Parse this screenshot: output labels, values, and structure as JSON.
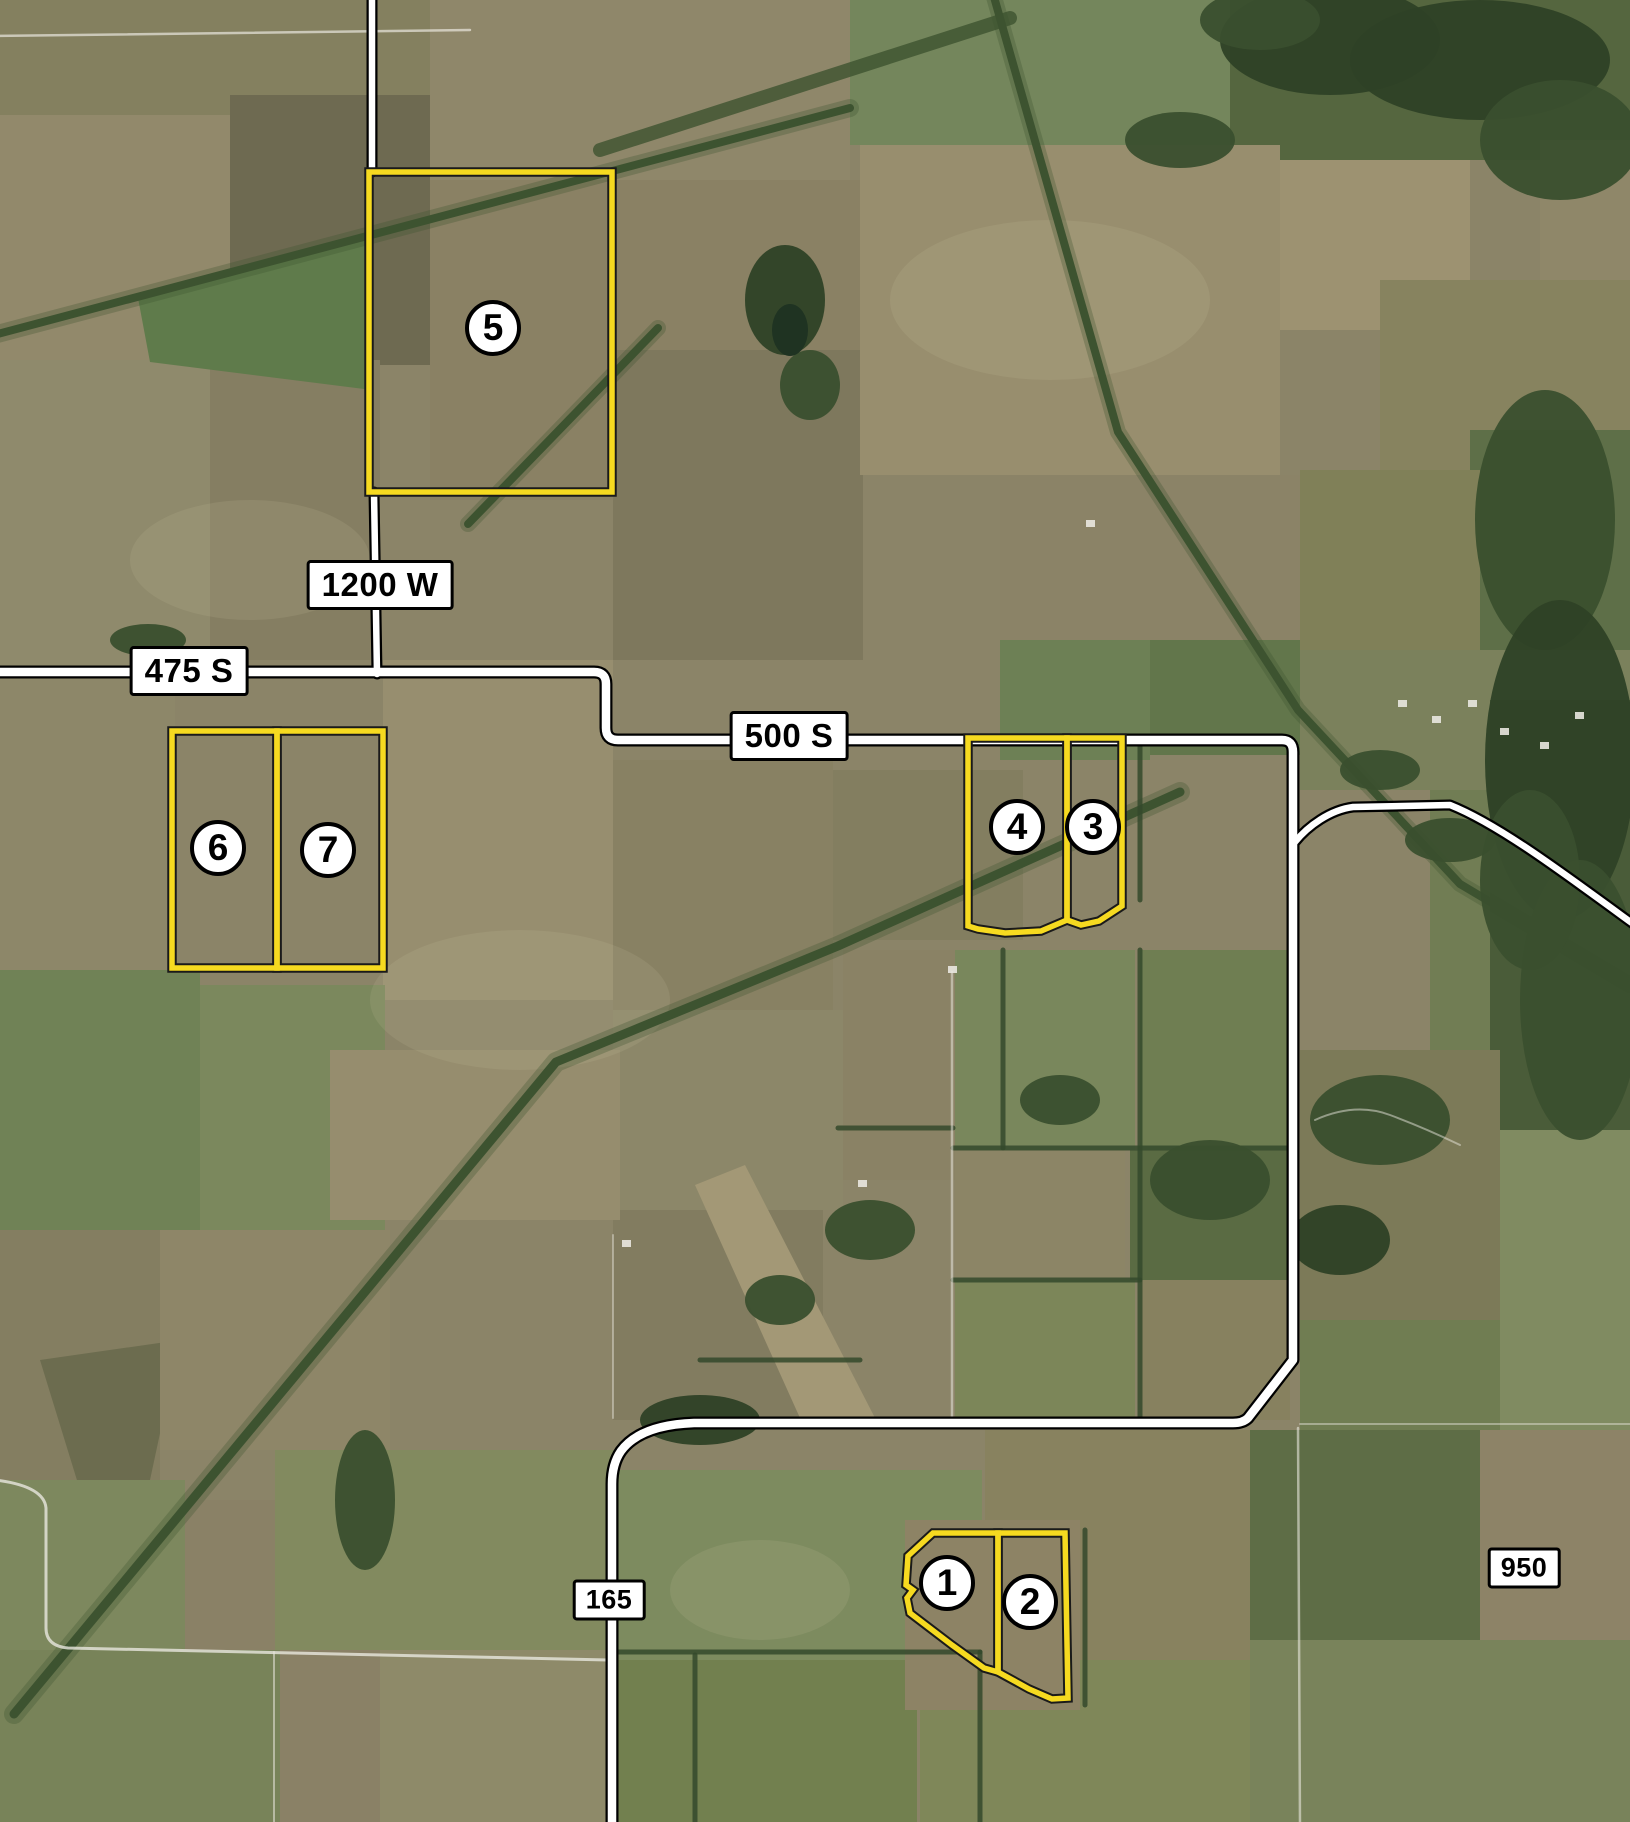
{
  "map": {
    "road_labels": [
      {
        "text": "1200 W"
      },
      {
        "text": "475 S"
      },
      {
        "text": "500 S"
      },
      {
        "text": "165"
      },
      {
        "text": "950"
      }
    ],
    "tracts": [
      {
        "number": "1"
      },
      {
        "number": "2"
      },
      {
        "number": "3"
      },
      {
        "number": "4"
      },
      {
        "number": "5"
      },
      {
        "number": "6"
      },
      {
        "number": "7"
      }
    ],
    "colors": {
      "parcel_outline": "#F6DA20",
      "outline_casing": "#1A1A1A",
      "road_highlight": "#FFFFFF",
      "road_casing": "#000000",
      "label_bg": "#FFFFFF",
      "label_border": "#000000",
      "label_text": "#000000",
      "marker_bg": "#FFFFFF",
      "marker_border": "#000000",
      "marker_text": "#000000"
    }
  }
}
